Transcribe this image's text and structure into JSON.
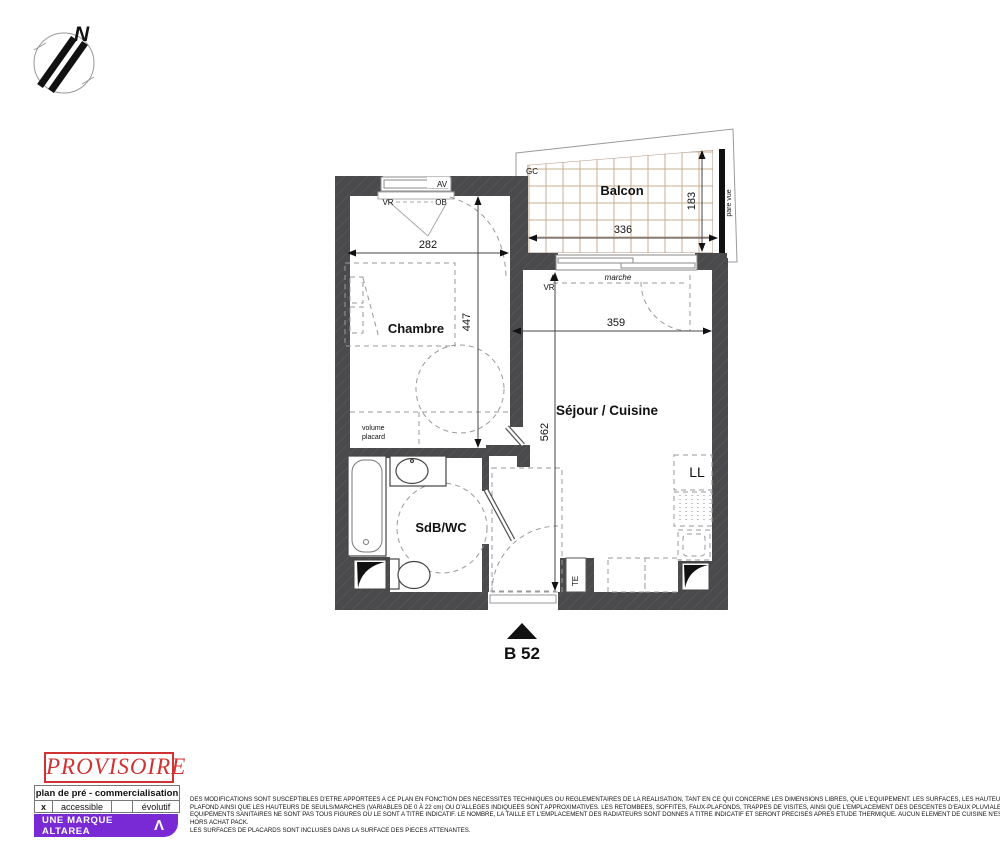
{
  "colors": {
    "wall": "#4a4a4d",
    "balcony_grid": "#c9ac93",
    "stamp_red": "#cf3334",
    "brand_purple": "#7a2ad4",
    "dash_gray": "#999999"
  },
  "compass": {
    "north": "N"
  },
  "plan": {
    "unit_label": "B 52",
    "rooms": {
      "chambre": "Chambre",
      "sejour_cuisine": "Séjour / Cuisine",
      "sdb_wc": "SdB/WC",
      "balcon": "Balcon"
    },
    "dims": {
      "chambre_width": "282",
      "chambre_depth": "447",
      "sejour_width": "359",
      "sejour_depth": "562",
      "balcon_width": "336",
      "balcon_depth": "183"
    },
    "tags": {
      "av": "AV",
      "vr_window": "VR",
      "ob": "OB",
      "gc": "GC",
      "pare_vue": "pare vue",
      "marche": "marche",
      "vr_bay": "VR",
      "volume_line1": "volume",
      "volume_line2": "placard",
      "ll": "LL",
      "te": "TE"
    }
  },
  "footer": {
    "stamp": "PROVISOIRE",
    "plan_type": "plan de pré - commercialisation",
    "accessibility": {
      "check": "x",
      "accessible": "accessible",
      "evolutif": "évolutif"
    },
    "brand": {
      "label": "UNE MARQUE ALTAREA",
      "logo": "Λ"
    },
    "disclaimer": [
      "DES MODIFICATIONS SONT SUSCEPTIBLES D'ETRE APPORTEES A CE PLAN EN FONCTION DES NECESSITES TECHNIQUES OU REGLEMENTAIRES DE LA REALISATION, TANT EN CE QUI CONCERNE LES DIMENSIONS LIBRES, QUE L'EQUIPEMENT. LES SURFACES, LES HAUTEURS SOUS",
      "PLAFOND AINSI QUE LES HAUTEURS DE SEUILS/MARCHES (VARIABLES DE 0 À 22 cm) OU D'ALLEGES INDIQUEES SONT APPROXIMATIVES. LES RETOMBEES, SOFFITES, FAUX-PLAFONDS, TRAPPES DE VISITES, AINSI QUE L'EMPLACEMENT DES DESCENTES D'EAUX PLUVIALES, DES",
      "EQUIPEMENTS SANITAIRES NE SONT PAS TOUS FIGURES OU LE SONT A TITRE INDICATIF. LE NOMBRE, LA TAILLE ET L'EMPLACEMENT DES RADIATEURS SONT DONNES A TITRE INDICATIF ET SERONT PRECISES APRES ETUDE THERMIQUE. AUCUN ELEMENT DE CUISINE N'EST FOURNI",
      "HORS ACHAT PACK.",
      "LES SURFACES DE PLACARDS SONT INCLUSES DANS LA SURFACE DES PIECES ATTENANTES."
    ]
  }
}
